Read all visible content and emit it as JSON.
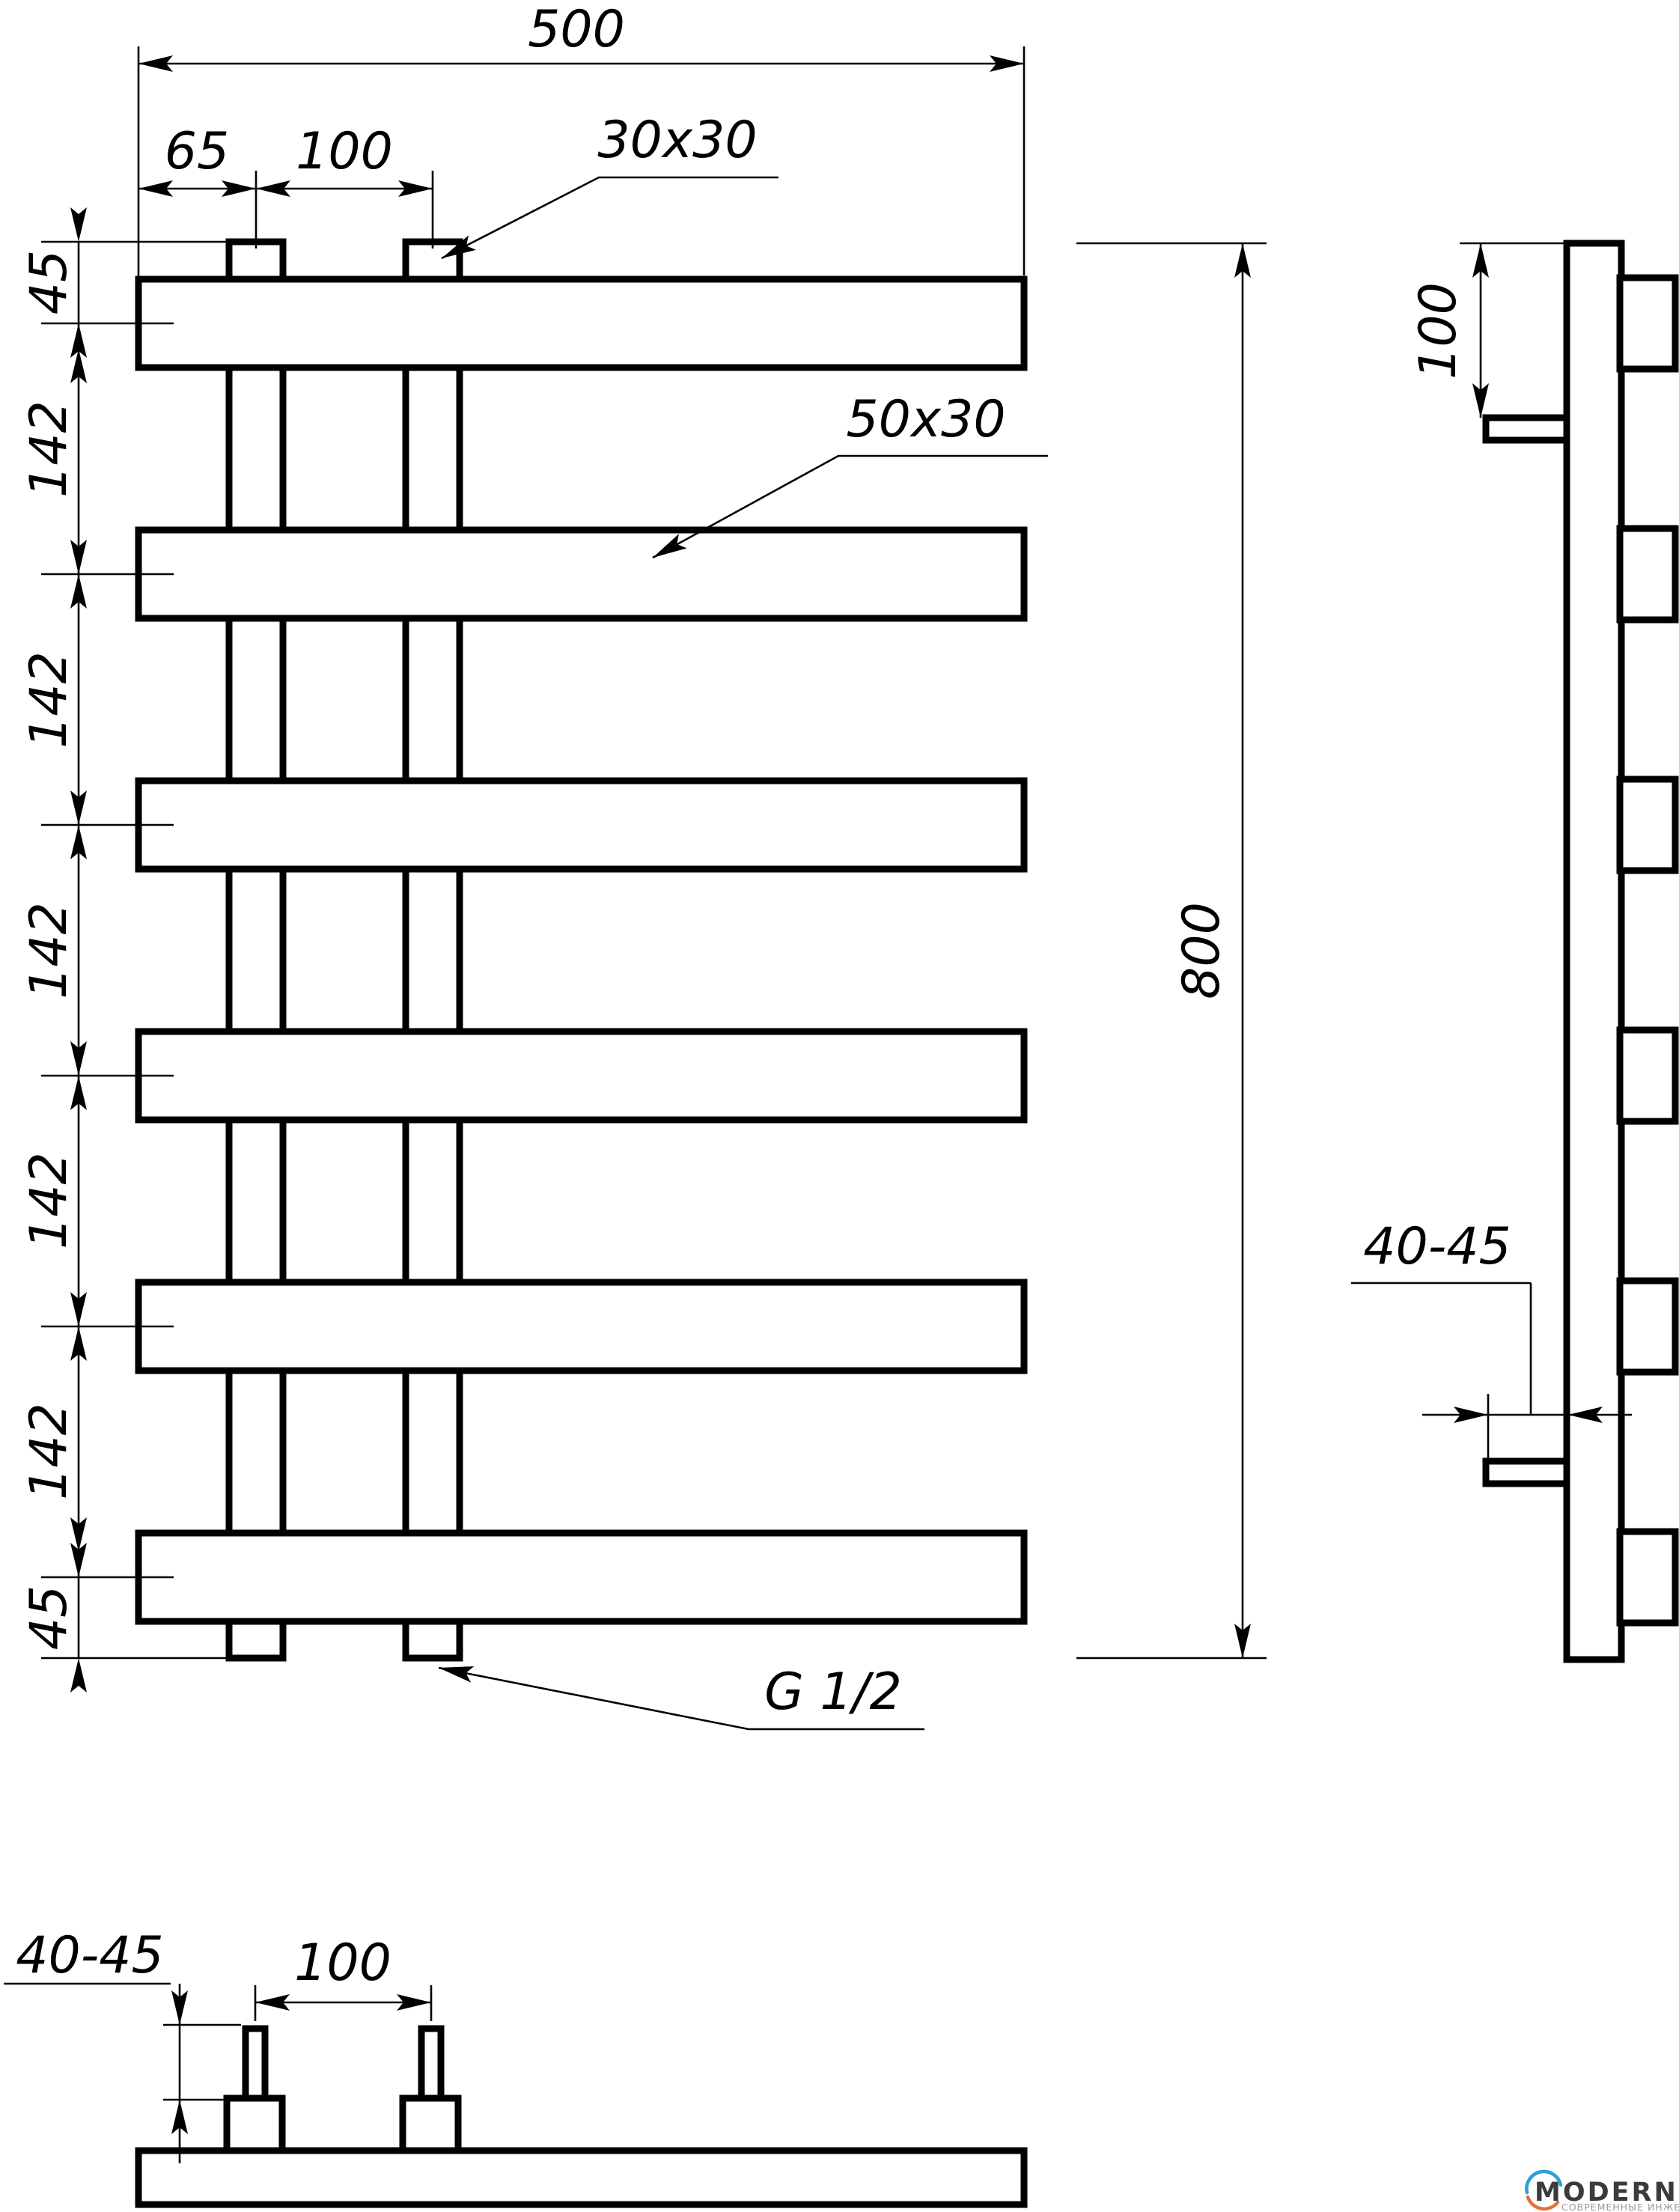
{
  "drawing": {
    "front": {
      "width": "500",
      "offset": "65",
      "riser_spacing": "100",
      "riser_profile": "30x30",
      "bar_profile": "50x30",
      "height": "800",
      "margin_top": "45",
      "gaps": [
        "142",
        "142",
        "142",
        "142",
        "142"
      ],
      "margin_bottom": "45",
      "thread": "G 1/2"
    },
    "side": {
      "bracket_offset": "100",
      "wall_distance": "40-45"
    },
    "bottom": {
      "pipe_length": "40-45",
      "pipe_spacing": "100"
    },
    "logo": {
      "brand": "MODERNSYS",
      "tagline": "СОВРЕМЕННЫЕ ИНЖЕНЕРНЫЕ СИСТЕМЫ",
      "brand_color": "#3b3b3d",
      "arc_top_color": "#2e9fd6",
      "arc_bottom_color": "#e2703a"
    },
    "line_color": "#000000",
    "background": "#ffffff"
  }
}
